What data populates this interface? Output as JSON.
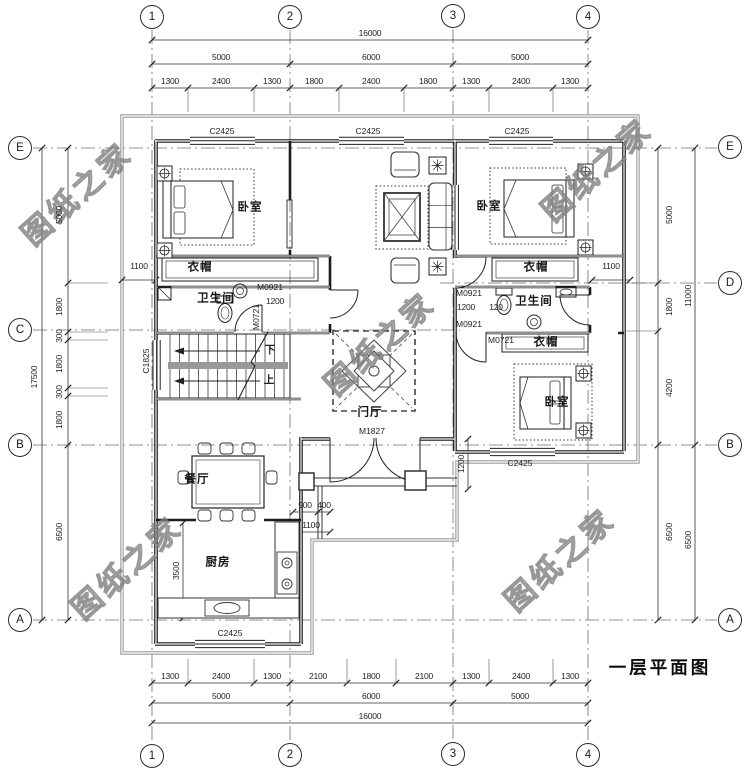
{
  "title": {
    "text": "一层平面图"
  },
  "watermark": {
    "text": "图纸之家",
    "positions": [
      {
        "x": 75,
        "y": 192
      },
      {
        "x": 595,
        "y": 168
      },
      {
        "x": 378,
        "y": 342
      },
      {
        "x": 125,
        "y": 566
      },
      {
        "x": 558,
        "y": 558
      }
    ]
  },
  "colors": {
    "paper": "#ffffff",
    "ink": "#1f1f1f",
    "dim": "#333333",
    "wm": "#909090"
  },
  "axis_bubbles": [
    {
      "label": "1",
      "x": 152,
      "y": 17
    },
    {
      "label": "2",
      "x": 290,
      "y": 17
    },
    {
      "label": "3",
      "x": 453,
      "y": 16
    },
    {
      "label": "4",
      "x": 588,
      "y": 17
    },
    {
      "label": "1",
      "x": 152,
      "y": 756
    },
    {
      "label": "2",
      "x": 290,
      "y": 755
    },
    {
      "label": "3",
      "x": 453,
      "y": 754
    },
    {
      "label": "4",
      "x": 588,
      "y": 755
    },
    {
      "label": "E",
      "x": 20,
      "y": 148
    },
    {
      "label": "C",
      "x": 20,
      "y": 330
    },
    {
      "label": "B",
      "x": 20,
      "y": 445
    },
    {
      "label": "A",
      "x": 20,
      "y": 620
    },
    {
      "label": "E",
      "x": 730,
      "y": 147
    },
    {
      "label": "D",
      "x": 730,
      "y": 283
    },
    {
      "label": "B",
      "x": 730,
      "y": 445
    },
    {
      "label": "A",
      "x": 730,
      "y": 620
    }
  ],
  "dimensions": [
    {
      "text": "16000",
      "x": 370,
      "y": 33
    },
    {
      "text": "5000",
      "x": 221,
      "y": 57
    },
    {
      "text": "6000",
      "x": 371,
      "y": 57
    },
    {
      "text": "5000",
      "x": 520,
      "y": 57
    },
    {
      "text": "1300",
      "x": 170,
      "y": 81
    },
    {
      "text": "2400",
      "x": 221,
      "y": 81
    },
    {
      "text": "1300",
      "x": 272,
      "y": 81
    },
    {
      "text": "1800",
      "x": 314,
      "y": 81
    },
    {
      "text": "2400",
      "x": 371,
      "y": 81
    },
    {
      "text": "1800",
      "x": 428,
      "y": 81
    },
    {
      "text": "1300",
      "x": 471,
      "y": 81
    },
    {
      "text": "2400",
      "x": 521,
      "y": 81
    },
    {
      "text": "1300",
      "x": 570,
      "y": 81
    },
    {
      "text": "1300",
      "x": 170,
      "y": 676
    },
    {
      "text": "2400",
      "x": 221,
      "y": 676
    },
    {
      "text": "1300",
      "x": 272,
      "y": 676
    },
    {
      "text": "2100",
      "x": 318,
      "y": 676
    },
    {
      "text": "1800",
      "x": 371,
      "y": 676
    },
    {
      "text": "2100",
      "x": 424,
      "y": 676
    },
    {
      "text": "1300",
      "x": 471,
      "y": 676
    },
    {
      "text": "2400",
      "x": 521,
      "y": 676
    },
    {
      "text": "1300",
      "x": 570,
      "y": 676
    },
    {
      "text": "5000",
      "x": 221,
      "y": 696
    },
    {
      "text": "6000",
      "x": 371,
      "y": 696
    },
    {
      "text": "5000",
      "x": 520,
      "y": 696
    },
    {
      "text": "16000",
      "x": 370,
      "y": 716
    },
    {
      "text": "17500",
      "x": 34,
      "y": 377,
      "rot": -90
    },
    {
      "text": "5000",
      "x": 59,
      "y": 215,
      "rot": -90
    },
    {
      "text": "1800",
      "x": 59,
      "y": 307,
      "rot": -90
    },
    {
      "text": "300",
      "x": 59,
      "y": 336,
      "rot": -90
    },
    {
      "text": "1800",
      "x": 59,
      "y": 364,
      "rot": -90
    },
    {
      "text": "300",
      "x": 59,
      "y": 392,
      "rot": -90
    },
    {
      "text": "1800",
      "x": 59,
      "y": 420,
      "rot": -90
    },
    {
      "text": "6500",
      "x": 59,
      "y": 532,
      "rot": -90
    },
    {
      "text": "1100",
      "x": 139,
      "y": 266
    },
    {
      "text": "5000",
      "x": 669,
      "y": 215,
      "rot": -90
    },
    {
      "text": "1800",
      "x": 669,
      "y": 307,
      "rot": -90
    },
    {
      "text": "4200",
      "x": 669,
      "y": 388,
      "rot": -90
    },
    {
      "text": "6500",
      "x": 669,
      "y": 532,
      "rot": -90
    },
    {
      "text": "11000",
      "x": 688,
      "y": 296,
      "rot": -90
    },
    {
      "text": "6500",
      "x": 688,
      "y": 540,
      "rot": -90
    },
    {
      "text": "1100",
      "x": 611,
      "y": 266
    },
    {
      "text": "1200",
      "x": 275,
      "y": 301
    },
    {
      "text": "1200",
      "x": 466,
      "y": 307
    },
    {
      "text": "120",
      "x": 496,
      "y": 307
    },
    {
      "text": "900",
      "x": 305,
      "y": 505
    },
    {
      "text": "400",
      "x": 324,
      "y": 505
    },
    {
      "text": "1100",
      "x": 311,
      "y": 525
    },
    {
      "text": "3500",
      "x": 176,
      "y": 571,
      "rot": -90
    },
    {
      "text": "1200",
      "x": 461,
      "y": 464,
      "rot": -90
    }
  ],
  "openings": [
    {
      "text": "C2425",
      "x": 222,
      "y": 131
    },
    {
      "text": "C2425",
      "x": 368,
      "y": 131
    },
    {
      "text": "C2425",
      "x": 517,
      "y": 131
    },
    {
      "text": "C2425",
      "x": 230,
      "y": 633
    },
    {
      "text": "C2425",
      "x": 520,
      "y": 463
    },
    {
      "text": "C1825",
      "x": 146,
      "y": 361,
      "rot": -90
    },
    {
      "text": "M0921",
      "x": 270,
      "y": 287
    },
    {
      "text": "M0721",
      "x": 256,
      "y": 317,
      "rot": -90
    },
    {
      "text": "M0921",
      "x": 469,
      "y": 293
    },
    {
      "text": "M0921",
      "x": 469,
      "y": 324
    },
    {
      "text": "M0721",
      "x": 501,
      "y": 340
    },
    {
      "text": "M1827",
      "x": 372,
      "y": 431
    }
  ],
  "rooms": [
    {
      "text": "卧室",
      "x": 250,
      "y": 208
    },
    {
      "text": "卧室",
      "x": 489,
      "y": 207
    },
    {
      "text": "卧室",
      "x": 557,
      "y": 403
    },
    {
      "text": "衣帽",
      "x": 200,
      "y": 268
    },
    {
      "text": "衣帽",
      "x": 536,
      "y": 268
    },
    {
      "text": "衣帽",
      "x": 546,
      "y": 343
    },
    {
      "text": "卫生间",
      "x": 216,
      "y": 299
    },
    {
      "text": "卫生间",
      "x": 534,
      "y": 302
    },
    {
      "text": "门厅",
      "x": 370,
      "y": 413
    },
    {
      "text": "餐厅",
      "x": 197,
      "y": 480
    },
    {
      "text": "厨房",
      "x": 218,
      "y": 563
    }
  ],
  "stair_notes": [
    {
      "text": "下",
      "x": 270,
      "y": 350
    },
    {
      "text": "上",
      "x": 269,
      "y": 380
    }
  ]
}
